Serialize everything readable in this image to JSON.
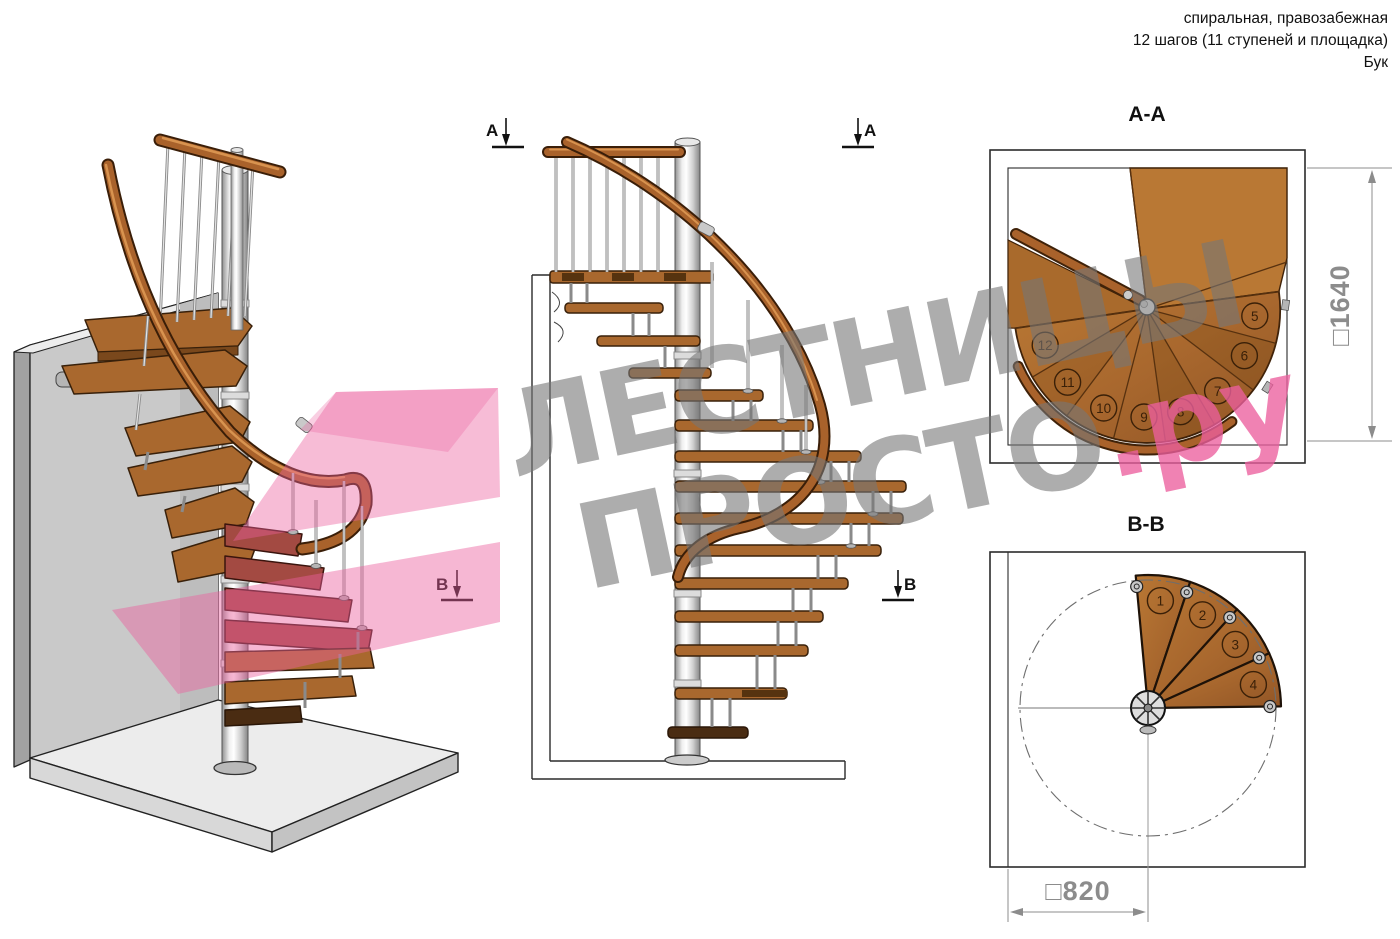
{
  "header": {
    "line1": "спиральная, правозабежная",
    "line2": "12 шагов (11 ступеней и площадка)",
    "line3": "Бук"
  },
  "watermark": {
    "line1": "ЛЕСТНИЦЫ",
    "line2": "ПРОСТО",
    "suffix": ".ру",
    "gray_color": "#a4a4a4",
    "pink_color": "#ec5f9e"
  },
  "sections": {
    "aa": {
      "title": "А-А",
      "dimension": "□1640",
      "step_numbers": [
        "5",
        "6",
        "7",
        "8",
        "9",
        "10",
        "11",
        "12"
      ]
    },
    "bb": {
      "title": "В-В",
      "dimension": "□820",
      "step_numbers": [
        "1",
        "2",
        "3",
        "4"
      ]
    }
  },
  "markers": {
    "a": "А",
    "b": "В"
  },
  "colors": {
    "wood": "#a9682e",
    "wood_dark": "#6e4316",
    "pole_gray": "#cfcfcf",
    "accent_pink": "#ec5f9e"
  }
}
